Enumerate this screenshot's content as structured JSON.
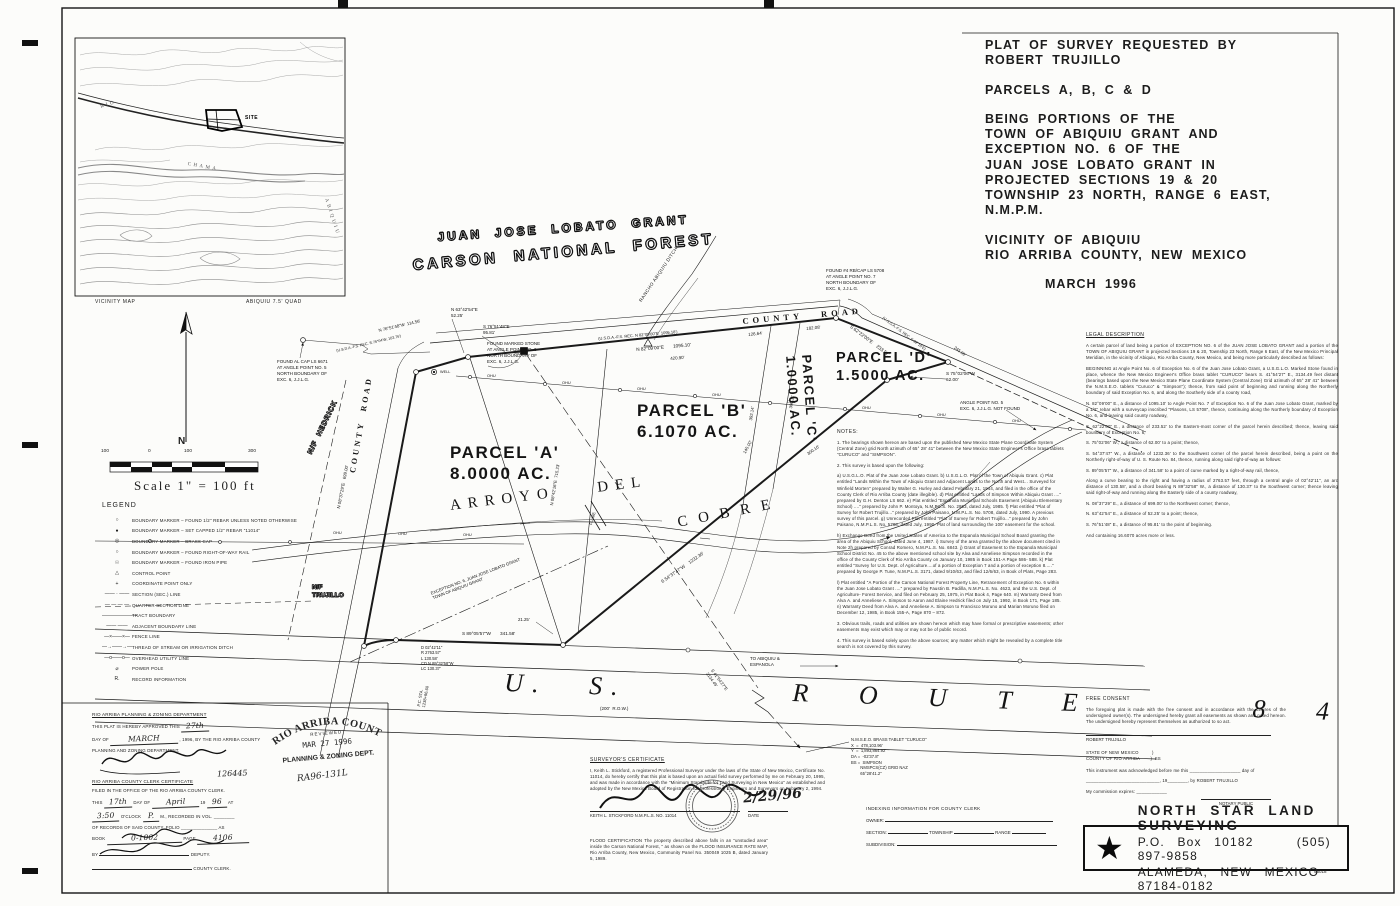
{
  "title_block": {
    "request": "PLAT OF SURVEY REQUESTED BY",
    "requester": "ROBERT TRUJILLO",
    "parcels": "PARCELS A, B, C & D",
    "being": [
      "BEING PORTIONS OF THE",
      "TOWN OF ABIQUIU GRANT AND",
      "EXCEPTION NO. 6 OF THE",
      "JUAN JOSE LOBATO GRANT IN",
      "PROJECTED SECTIONS 19 & 20",
      "TOWNSHIP 23 NORTH, RANGE 6 EAST, N.M.P.M."
    ],
    "vicinity": [
      "VICINITY OF ABIQUIU",
      "RIO ARRIBA COUNTY, NEW MEXICO"
    ],
    "date": "MARCH 1996"
  },
  "vicinity": {
    "caption_left": "VICINITY MAP",
    "caption_right": "ABIQUIU 7.5' QUAD",
    "labels": [
      {
        "t": "RIO",
        "x": 100,
        "y": 105,
        "r": -18
      },
      {
        "t": "CHAMA",
        "x": 188,
        "y": 162,
        "r": 10
      },
      {
        "t": "ABIQUIU",
        "x": 328,
        "y": 198,
        "r": 72
      },
      {
        "t": "SITE",
        "x": 245,
        "y": 115,
        "r": 0,
        "c": "vsite"
      }
    ]
  },
  "map": {
    "north_label": "N",
    "annotations": [
      {
        "t": "JUAN  JOSE  LOBATO  GRANT",
        "x": 437,
        "y": 230,
        "r": -4,
        "s": 12,
        "ls": 3,
        "c": "outline"
      },
      {
        "t": "CARSON  NATIONAL  FOREST",
        "x": 412,
        "y": 256,
        "r": -5,
        "s": 15,
        "ls": 3.5,
        "c": "outline"
      },
      {
        "t": "RANCHO ABIQUIU DITCH",
        "x": 638,
        "y": 300,
        "r": -56,
        "s": 4.6,
        "ls": 0.5
      },
      {
        "t": "COUNTY   ROAD",
        "x": 742,
        "y": 316,
        "r": -5,
        "s": 8.5,
        "ls": 4,
        "c": "roadlab"
      },
      {
        "t": "COUNTY  ROAD",
        "x": 348,
        "y": 472,
        "r": -80,
        "s": 8,
        "ls": 3,
        "c": "roadlab"
      },
      {
        "t": "N 08°37'29\"E   699.00'",
        "x": 336,
        "y": 508,
        "r": -79,
        "s": 4.4
      },
      {
        "t": "N/F  HEDRICK",
        "x": 306,
        "y": 452,
        "r": -64,
        "s": 7,
        "ls": 1,
        "c": "outline2"
      },
      {
        "t": "N/F\nTRUJILLO",
        "x": 312,
        "y": 584,
        "s": 6.5,
        "c": "outline2"
      },
      {
        "t": "FOUND AL CAP LS 6671\nAT ANGLE POINT NO. 5\nNORTH BOUNDARY OF\nEXC. 6, J.J.L.G.",
        "x": 277,
        "y": 359,
        "s": 4.5
      },
      {
        "t": "N 76°51'48\"W  114.56'",
        "x": 378,
        "y": 328,
        "r": -13,
        "s": 4.3
      },
      {
        "t": "(U.S.D.A.-F.S. REC. S.76°04'W, 103.76')",
        "x": 336,
        "y": 349,
        "r": -13,
        "s": 3.7
      },
      {
        "t": "N 63°42'54\"E\n52.25'",
        "x": 451,
        "y": 307,
        "s": 4.5
      },
      {
        "t": "S 76°51'48\"E\n95.81'",
        "x": 483,
        "y": 324,
        "s": 4.5
      },
      {
        "t": "FOUND MARKED STONE\nAT ANGLE POINT NO. 6\nNORTH BOUNDARY OF\nEXC. 6, J.J.L.G.",
        "x": 487,
        "y": 341,
        "s": 4.5
      },
      {
        "t": "363.48'",
        "x": 514,
        "y": 350,
        "r": -5,
        "s": 4.5
      },
      {
        "t": "(U.S.D.A.-F.S. REC. N 82°09'00\"E  1095.18')",
        "x": 598,
        "y": 336,
        "r": -5,
        "s": 4
      },
      {
        "t": "N 82°09'00\"E       1095.10'",
        "x": 636,
        "y": 347,
        "r": -5,
        "s": 4.7
      },
      {
        "t": "420.90'",
        "x": 670,
        "y": 356,
        "r": -5,
        "s": 4.4
      },
      {
        "t": "126.64'",
        "x": 748,
        "y": 332,
        "r": -6,
        "s": 4.4
      },
      {
        "t": "182.08'",
        "x": 806,
        "y": 326,
        "r": -6,
        "s": 4.4
      },
      {
        "t": "FOUND #4 RB/CAP LS 5708\nAT ANGLE POINT NO. 7\nNORTH BOUNDARY OF\nEXC. 6, J.J.L.G.",
        "x": 826,
        "y": 268,
        "s": 4.5
      },
      {
        "t": "S 62°22'00\"E    233.52'",
        "x": 852,
        "y": 324,
        "r": 37,
        "s": 4.7
      },
      {
        "t": "(U.S.D.A.-F.S. REC. S 62°10'E)",
        "x": 884,
        "y": 316,
        "r": 37,
        "s": 3.8
      },
      {
        "t": "245.99'",
        "x": 956,
        "y": 345,
        "r": 37,
        "s": 4.3
      },
      {
        "t": "S 75°02'06\"W\n62.00'",
        "x": 946,
        "y": 371,
        "s": 4.7
      },
      {
        "t": "ANGLE POINT NO. 5\nEXC. 6, J.J.L.G. NOT FOUND",
        "x": 960,
        "y": 400,
        "s": 4.5
      },
      {
        "t": "PARCEL 'A'\n8.0000 AC.",
        "x": 450,
        "y": 442,
        "s": 17,
        "c": "parcel"
      },
      {
        "t": "PARCEL 'B'\n6.1070 AC.",
        "x": 637,
        "y": 400,
        "s": 17,
        "c": "parcel"
      },
      {
        "t": "PARCEL 'C'\n1.0000 AC.",
        "x": 814,
        "y": 354,
        "r": 86,
        "s": 13,
        "c": "parcel"
      },
      {
        "t": "PARCEL 'D'\n1.5000 AC.",
        "x": 836,
        "y": 349,
        "s": 14.5,
        "c": "parcel"
      },
      {
        "t": "ARROYO    DEL",
        "x": 449,
        "y": 497,
        "r": -7,
        "s": 15,
        "ls": 7,
        "c": "streamlab"
      },
      {
        "t": "COBRE",
        "x": 676,
        "y": 514,
        "r": -11,
        "s": 15,
        "ls": 11,
        "c": "streamlab"
      },
      {
        "t": "EXCEPTION NO. 6, JUAN JOSE LOBATO GRANT\nTOWN OF ABIQUIU GRANT",
        "x": 430,
        "y": 591,
        "r": -21,
        "s": 4.2
      },
      {
        "t": "N 08°42'16\"E  715.23'",
        "x": 549,
        "y": 505,
        "r": -81,
        "s": 4.3
      },
      {
        "t": "S 54°37'47\"W    1232.36'",
        "x": 660,
        "y": 580,
        "r": -35,
        "s": 4.6
      },
      {
        "t": "300.10'",
        "x": 806,
        "y": 452,
        "r": -35,
        "s": 4.3
      },
      {
        "t": "145.00'",
        "x": 742,
        "y": 452,
        "r": -62,
        "s": 4.3
      },
      {
        "t": "392.14'",
        "x": 748,
        "y": 420,
        "r": -81,
        "s": 4.3
      },
      {
        "t": "306.11'",
        "x": 788,
        "y": 408,
        "r": -81,
        "s": 4.3
      },
      {
        "t": "FLUME",
        "x": 588,
        "y": 524,
        "r": -73,
        "s": 3.9
      },
      {
        "t": "WELL",
        "x": 440,
        "y": 370,
        "s": 3.8
      },
      {
        "t": "21.25'",
        "x": 518,
        "y": 617,
        "s": 4.3
      },
      {
        "t": "S 89°05'57\"W       341.58'",
        "x": 462,
        "y": 631,
        "s": 4.7
      },
      {
        "t": "D 02°42'11\"\nR 2763.57'\nL 130.58'\nCD N 89°32'58\"W\nLC 130.37'",
        "x": 421,
        "y": 645,
        "s": 4.1
      },
      {
        "t": "P.C. STA.\n1238+96.60",
        "x": 416,
        "y": 706,
        "r": -80,
        "s": 4.1
      },
      {
        "t": "U. S.    R O U T E    8 4",
        "x": 505,
        "y": 666,
        "r": 2,
        "s": 26,
        "ls": 9,
        "c": "hwylab"
      },
      {
        "t": "(200'  R.O.W.)",
        "x": 600,
        "y": 706,
        "s": 4.5
      },
      {
        "t": "TO ABIQUIU &\nESPANOLA",
        "x": 750,
        "y": 656,
        "s": 4.5
      },
      {
        "t": "S 41°54'27\"E\n3134.49'",
        "x": 714,
        "y": 668,
        "r": 54,
        "s": 4.3
      },
      {
        "t": "OHU",
        "x": 487,
        "y": 373,
        "s": 3.9
      },
      {
        "t": "OHU",
        "x": 562,
        "y": 380,
        "s": 3.9
      },
      {
        "t": "OHU",
        "x": 637,
        "y": 386,
        "s": 3.9
      },
      {
        "t": "OHU",
        "x": 712,
        "y": 392,
        "s": 3.9
      },
      {
        "t": "OHU",
        "x": 787,
        "y": 399,
        "s": 3.9
      },
      {
        "t": "OHU",
        "x": 862,
        "y": 405,
        "s": 3.9
      },
      {
        "t": "OHU",
        "x": 937,
        "y": 412,
        "s": 3.9
      },
      {
        "t": "OHU",
        "x": 1012,
        "y": 418,
        "s": 3.9
      },
      {
        "t": "OHU",
        "x": 333,
        "y": 530,
        "s": 3.9
      },
      {
        "t": "OHU",
        "x": 398,
        "y": 531,
        "s": 3.9
      },
      {
        "t": "OHU",
        "x": 463,
        "y": 532,
        "s": 3.9
      }
    ]
  },
  "scale": {
    "ticks": [
      "100",
      "0",
      "100",
      "300"
    ],
    "label": "Scale 1\" = 100 ft"
  },
  "legend": {
    "title": "LEGEND",
    "items": [
      {
        "sym": "○",
        "label": "BOUNDARY MARKER – FOUND 1/2\" REBAR UNLESS NOTED OTHERWISE"
      },
      {
        "sym": "●",
        "label": "BOUNDARY MARKER – SET CAPPED 1/2\" REBAR \"11014\""
      },
      {
        "sym": "◎",
        "label": "BOUNDARY MARKER – BRASS CAP"
      },
      {
        "sym": "○",
        "label": "BOUNDARY MARKER – FOUND RIGHT-OF-WAY RAIL"
      },
      {
        "sym": "☉",
        "label": "BOUNDARY MARKER – FOUND IRON PIPE"
      },
      {
        "sym": "△",
        "label": "CONTROL POINT"
      },
      {
        "sym": "+",
        "label": "COORDINATE POINT ONLY"
      },
      {
        "sym": "—— · ——",
        "label": "SECTION (SEC.) LINE"
      },
      {
        "sym": "— — — —",
        "label": "QUARTER SECTION LINE"
      },
      {
        "sym": "———————",
        "label": "TRACT BOUNDARY"
      },
      {
        "sym": "—— ——",
        "label": "ADJACENT BOUNDARY LINE"
      },
      {
        "sym": "—×——×—",
        "label": "FENCE LINE"
      },
      {
        "sym": "—→——→—",
        "label": "THREAD OF STREAM OR IRRIGATION DITCH"
      },
      {
        "sym": "—ο——ο—",
        "label": "OVERHEAD UTILITY LINE"
      },
      {
        "sym": "⌀",
        "label": "POWER POLE"
      },
      {
        "sym": "R.",
        "label": "RECORD INFORMATION"
      }
    ]
  },
  "legal": {
    "title": "LEGAL DESCRIPTION",
    "paragraphs": [
      "A certain parcel of land being a portion of EXCEPTION NO. 6 of the JUAN JOSE LOBATO GRANT and a portion of the TOWN OF ABIQUIU GRANT in projected Sections 19 & 20, Township 23 North, Range 6 East, of the New Mexico Principal Meridian, in the vicinity of Abiquiu, Rio Arriba County, New Mexico, and being more particularly described as follows:",
      "BEGINNING at Angle Point No. 6 of Exception No. 6 of the Juan Jose Lobato Grant, a U.S.G.L.O. Marked Stone found in place, whence the New Mexico Engineer's Office brass tablet \"CURUCO\" bears S. 41°54'27\" E., 3134.49 feet distant (bearings based upon the New Mexico State Plane Coordinate System (Central Zone) Grid azimuth of 65° 28' 41\" between the N.M.S.E.O. tablets \"Curuco\" & \"Simpson\"); thence, from said point of beginning and running along the Northerly boundary of said Exception No. 6, and along the Southerly side of a county road,",
      "N. 82°09'00\" E., a distance of     1095.10' to Angle Point No. 7 of Exception No. 6 of the Juan Jose Lobato Grant, marked by a 1/2\" rebar with a surveycap inscribed \"Plasons, LS 5708\", thence, continuing along the Northerly boundary of Exception No. 6, and leaving said county roadway,",
      "S. 62°22'00\" E., a distance of      233.52' to the Eastern-most corner of the parcel herein described; thence, leaving said boundary of Exception No. 6,",
      "S. 75°02'06\" W., a distance of       62.00' to a point; thence,",
      "S. 54°37'47\" W., a distance of     1232.36' to the Southwest corner of the parcel herein described, being a point on the Northerly right-of-way of U. S. Route No. 84, thence, running along said right-of-way as follows:",
      "S. 89°05'57\" W., a distance of      341.58' to a point of curve marked by a right-of-way rail, thence,",
      "Along a curve bearing to the right and having a radius of 2763.57 feet, through a central angle of 02°42'11\", an arc distance of      130.58', and a chord bearing N 89°32'58\" W., a distance of 130.37' to the Southwest corner; thence leaving said right-of-way and running along the Easterly side of a county roadway,",
      "N. 08°37'29\" E., a distance of      699.00' to the Northwest corner; thence,",
      "N. 63°42'54\" E., a distance of       52.25' to a point; thence,",
      "S. 76°51'48\" E., a distance of       95.81' to the point of beginning.",
      "And containing 16.6070 acres more or less."
    ]
  },
  "notes": {
    "title": "NOTES:",
    "paragraphs": [
      "1. The bearings shown hereon are based upon the published New Mexico State Plane Coordinate System (Central Zone) grid North azimuth of 65° 28' 41\" between the New Mexico State Engineer's Office brass tablets \"CURUCO\" and \"SIMPSON\".",
      "2. This survey is based upon the following:",
      "a) U.S.G.L.O. Plat of the Juan Jose Lobato Grant. b) U.S.G.L.O. Plat of the Town of Abiquiu Grant. c) Plat entitled \"Lands Within the Town of Abiquiu Grant and Adjacent Lands to the North and West... Surveyed for Winfield Morten\" prepared by Walter G. Hurley and dated February 21, 1944, and filed in the office of the County Clerk of Rio Arriba County (date illegible). d) Plat entitled \"Lands of Simpson Within Abiquiu Grant ....\" prepared by G.H. Denton LS 662. e) Plat entitled \"Espanola Municipal Schools Easement (Abiquiu Elementary School) ....\" prepared by John P. Montoya, N.M.P.L.S. No. 2953, dated July, 1985. f) Plat entitled \"Plat of Survey for Robert Trujillo...\" prepared by John Paisano, N.M.P.L.S. No. 5708, dated July, 1990. A previous survey of this parcel. g) Unrecorded Plat entitled \"Plat of Survey for Robert Trujillo...\" prepared by John Paisano, N.M.P.L.S. No. 5708, dated July, 1990. Plat of land surrounding the 100' easement for the school.",
      "h) Exchange Deed from the United States of America to the Espanola Municipal School Board granting the area of the Abiquiu School, dated June 4, 1987. i) Survey of the area granted by the above document cited in Note 2h prepared by Conrad Romero, N.M.P.L.S. No. 6843. j) Grant of Easement to the Espanola Municipal School District No. 45 to the above mentioned school site by Alva and Anneliese Simpson recorded in the office of the County Clerk of Rio Arriba County on January 10, 1985 in Book 151-A Page 586- 588. k) Plat entitled \"Survey for U.S. Dept. of Agriculture....of a portion of Exception 7 and a portion of exception 8.....\" prepared by George P. Tune, N.M.P.L.S. 3171, dated 9/10/63, and filed 12/6/63, in Book of Plats, Page 283.",
      "l) Plat entitled \"A Portion of the Carson National Forest Property Line, Retracement of Exception No. 6 within the Juan Jose Lobato Grant ....\" prepared by Faustin B. Padilla, N.M.P.L.S. No. 4623, and the U.S. Dept. of Agriculture- Forest Service, and filed on February 25, 1975, in Plat Book 4, Page 640. m) Warranty Deed from Alva A. and Anneliese A. Simpson to Aaron and Elaine Hedrick filed on July 15, 1992, in Book 171, Page 185. n) Warranty Deed from Alva A. and Anneliese A. Simpson to Francisco Moruno and Marian Moruno filed on December 12, 1985, in Book 155-A, Page 870 – 872.",
      "3. Obvious trails, roads and utilities are shown hereon which may have formal or prescriptive easements; other easements may exist which may or may not be of public record.",
      "4. This survey is based solely upon the above sources; any matter which might be revealed by a complete title search is not covered by this survey."
    ]
  },
  "approval": {
    "dept_heading": "RIO ARRIBA PLANNING & ZONING DEPARTMENT",
    "approved_pre": "THIS PLAT IS HEREBY APPROVED THIS",
    "approved_day": "27th",
    "dayof": "DAY OF",
    "month": "MARCH",
    "approved_post": ", 1996, BY THE RIO ARRIBA COUNTY",
    "dept_line": "PLANNING AND ZONING DEPARTMENT.",
    "file_no": "126445",
    "clerk_heading": "RIO ARRIBA COUNTY CLERK CERTIFICATE",
    "filed_line": "FILED IN THE OFFICE OF THE RIO ARRIBA COUNTY CLERK.",
    "this": "THIS",
    "day17": "17th",
    "dayof2": "DAY OF",
    "month2": "April",
    "yr": "19",
    "yr2": "96",
    "at": "AT",
    "time": "3:50",
    "oclock": "O'CLOCK",
    "pm": "P.",
    "recorded": "M., RECORDED IN VOL. ________",
    "folio_line": "OF RECORDS OF SAID COUNTY, FOLIO ______________ AS",
    "book_lbl": "BOOK",
    "book": "0-1002",
    "page_lbl": "PAGE",
    "page": "4106",
    "by": "BY",
    "deputy": "DEPUTY.",
    "county_clerk": "COUNTY CLERK."
  },
  "stamp": {
    "arc": "RIO ARRIBA COUNTY",
    "reviewed": "REVIEWED",
    "date": "MAR 27 1996",
    "dept": "PLANNING & ZONING DEPT.",
    "ref": "RA96-131L"
  },
  "surveyor": {
    "heading": "SURVEYOR'S CERTIFICATE",
    "body": "I, Keith L. Stickford, a registered Professional Surveyor under the laws of the State of New Mexico, Certificate No. 11014, do hereby certify that this plat is based upon an actual field survey performed by me on February 20, 1995, and was made in accordance with the \"Minimum Standards for Land Surveying in New Mexico\" as established and adopted by the New Mexico Board of Registration for Professional Engineers and Surveyors on February 2, 1994.",
    "name_line": "KEITH L. STICKFORD   N.M.P.L.S. NO. 11014",
    "date_lbl": "DATE",
    "date_hand": "2/29/96"
  },
  "flood": {
    "text": "FLOOD CERTIFICATION    The property described above falls in an \"unstudied area\" inside the Carson National Forest, \" as shown on the FLOOD INSURANCE RATE MAP, Rio Arriba County, New Mexico, Community Panel No. 350049 1025 B, dated January 5, 1989."
  },
  "tablet": {
    "lines": [
      "N.M.S.E.O. BRASS TABLET \"CURUCO\"",
      "X  =  478,103.96'",
      "Y  =  1,893,864.92'",
      "DA =  -02'37.8\"",
      "BS =  SIMPSON",
      "        NMSPCS(CZ) GRID NAZ",
      "        65°28'41.2\""
    ]
  },
  "indexing": {
    "title": "INDEXING INFORMATION FOR COUNTY CLERK",
    "owner": "OWNER:",
    "section": "SECTION:",
    "township": "TOWNSHIP",
    "range": "RANGE",
    "subdivision": "SUBDIVISION:"
  },
  "consent": {
    "heading": "FREE CONSENT",
    "body": "The foregoing plat is made with the free consent and in accordance with the desires of the undersigned owner(s).  The undersigned hereby grant all easements as shown and noted hereon.  The undersigned hereby represent themselves as authorized to so act.",
    "owner": "ROBERT TRUJILLO",
    "state_line": "STATE OF NEW MEXICO          )",
    "county_line": "COUNTY OF RIO ARRIBA        )  SS",
    "ack1": "This instrument was acknowledged before me this ____________________ day of",
    "ack2": "_____________________________, 19________, by ROBERT TRUJILLO",
    "expires": "My commission expires: ____________",
    "notary": "NOTARY PUBLIC"
  },
  "firm": {
    "star_icon": "★",
    "name": "NORTH STAR LAND SURVEYING",
    "line2a": "P.O. Box 10182",
    "line2b": "(505) 897-9858",
    "city": "ALAMEDA, NEW MEXICO  87184-0182",
    "sheet_no": "96018"
  }
}
